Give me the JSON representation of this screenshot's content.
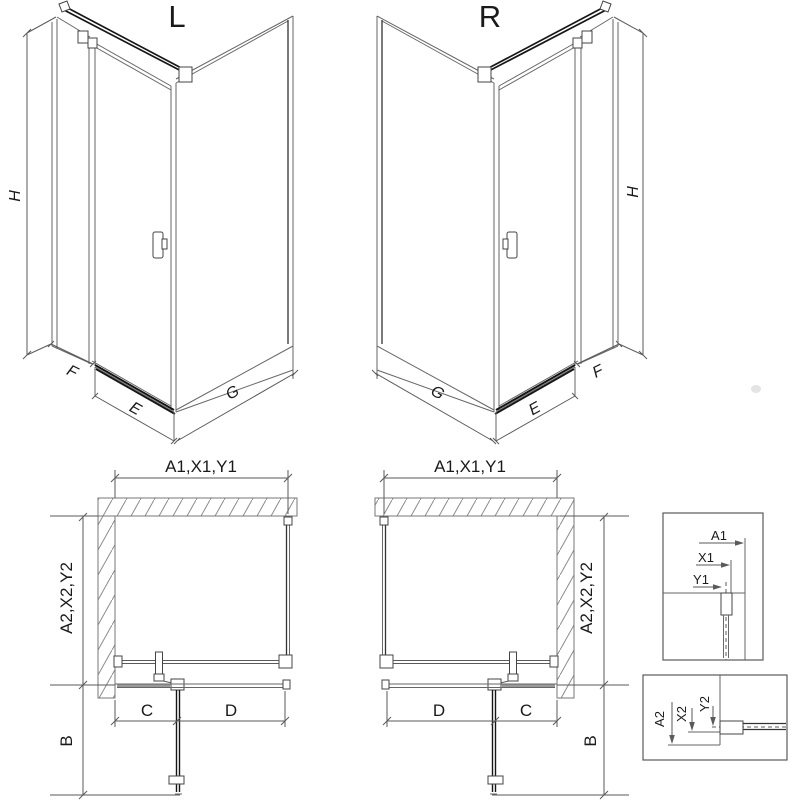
{
  "iso_left": {
    "variant_label": "L",
    "height_label": "H",
    "side_panel_width_label": "F",
    "door_width_label": "E",
    "fixed_panel_width_label": "G"
  },
  "iso_right": {
    "variant_label": "R",
    "height_label": "H",
    "side_panel_width_label": "F",
    "door_width_label": "E",
    "fixed_panel_width_label": "G"
  },
  "plan_left": {
    "top_dim_label": "A1,X1,Y1",
    "side_dim_label": "A2,X2,Y2",
    "front_left_dim_label": "C",
    "front_right_dim_label": "D",
    "door_swing_dim_label": "B"
  },
  "plan_right": {
    "top_dim_label": "A1,X1,Y1",
    "side_dim_label": "A2,X2,Y2",
    "front_left_dim_label": "D",
    "front_right_dim_label": "C",
    "door_swing_dim_label": "B"
  },
  "detail_top": {
    "dim_labels": [
      "A1",
      "X1",
      "Y1"
    ]
  },
  "detail_bottom": {
    "dim_labels": [
      "A2",
      "X2",
      "Y2"
    ]
  },
  "colors": {
    "line": "#666666",
    "dark_line": "#161616",
    "dimension_line": "#5a5a5a",
    "hatch": "#8a8a8a",
    "text": "#1a1a1a",
    "background": "#ffffff"
  }
}
